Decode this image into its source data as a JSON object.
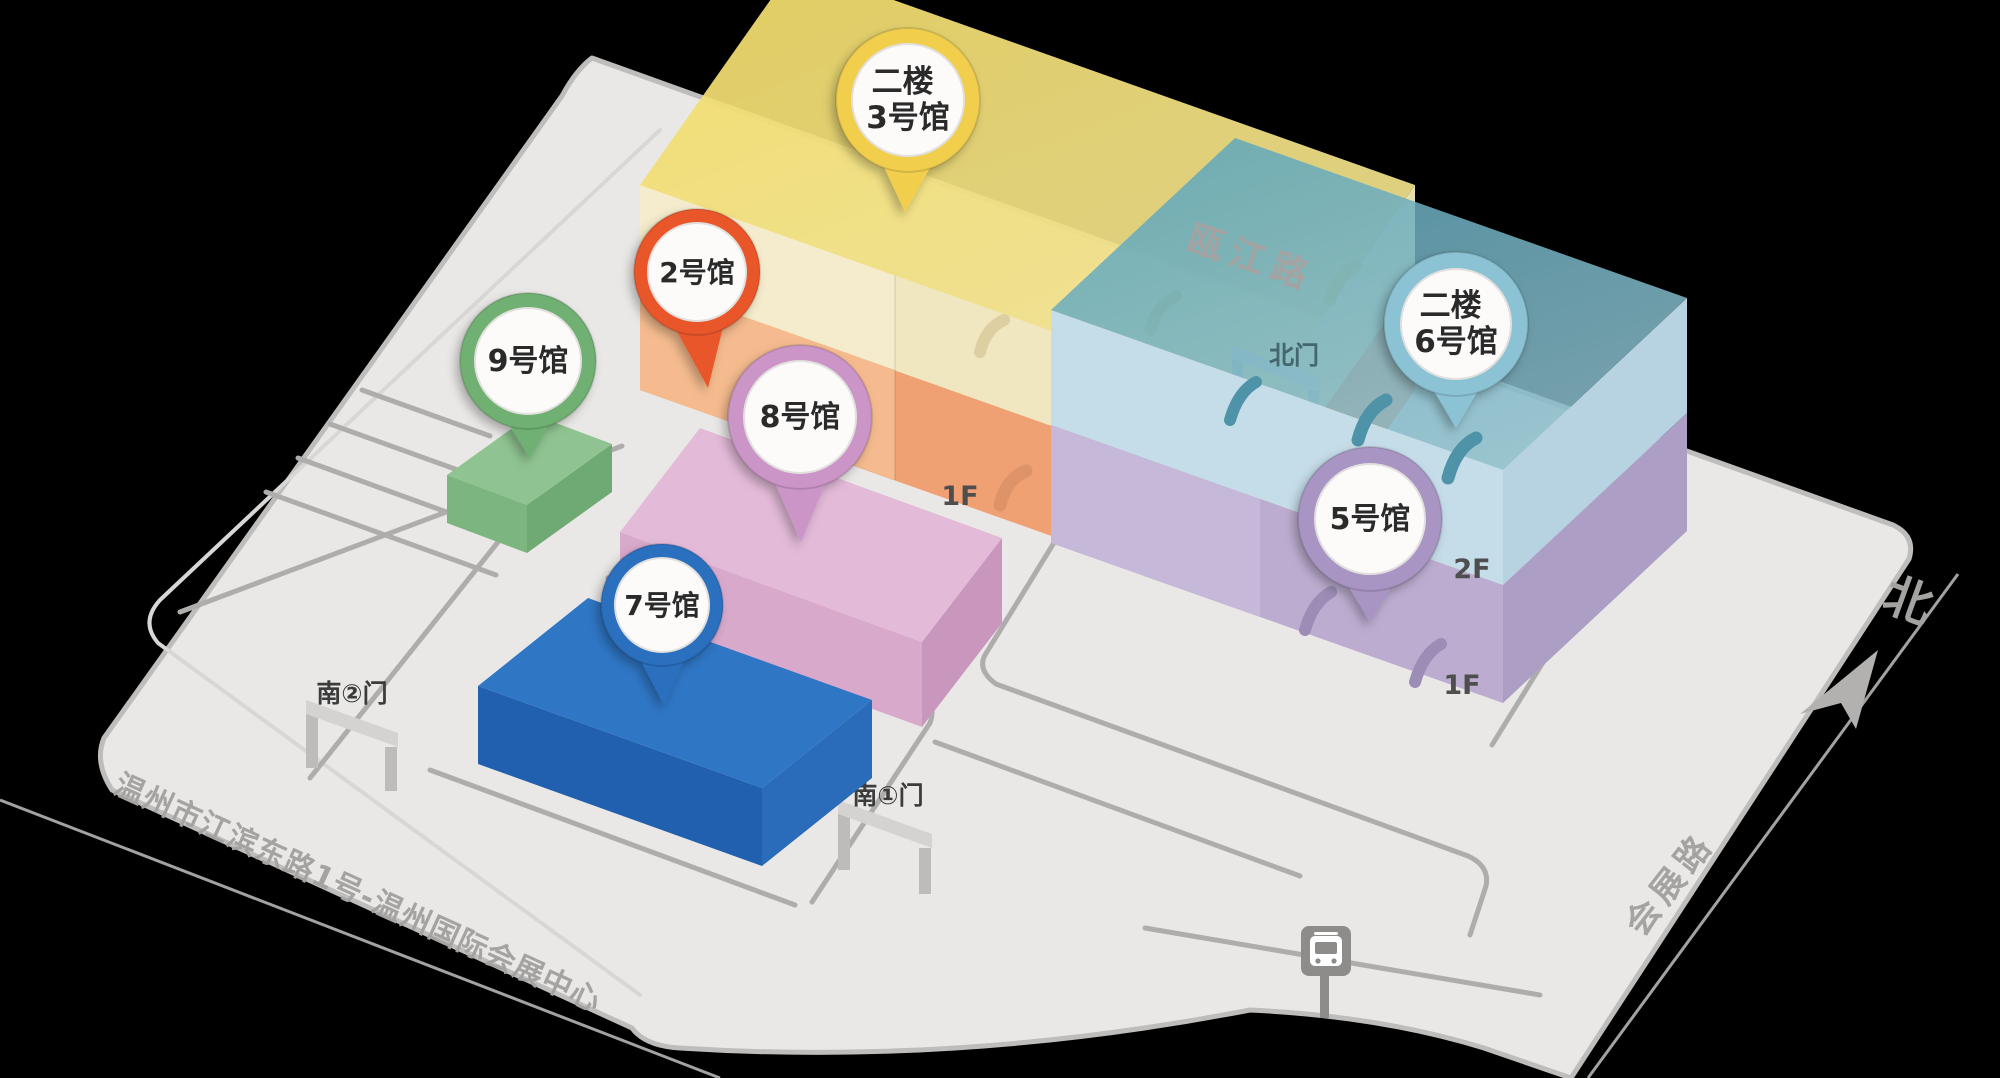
{
  "map": {
    "background": "#000000",
    "ground": "#E9E8E6"
  },
  "pins": [
    {
      "id": "hall-3",
      "lines": [
        "二楼",
        "3号馆"
      ],
      "color": "#F2CE4E"
    },
    {
      "id": "hall-2",
      "lines": [
        "2号馆"
      ],
      "color": "#E8562B"
    },
    {
      "id": "hall-9",
      "lines": [
        "9号馆"
      ],
      "color": "#6FB072"
    },
    {
      "id": "hall-8",
      "lines": [
        "8号馆"
      ],
      "color": "#CB95C7"
    },
    {
      "id": "hall-7",
      "lines": [
        "7号馆"
      ],
      "color": "#2B6FBE"
    },
    {
      "id": "hall-6",
      "lines": [
        "二楼",
        "6号馆"
      ],
      "color": "#8BC3D4"
    },
    {
      "id": "hall-5",
      "lines": [
        "5号馆"
      ],
      "color": "#A995C3"
    }
  ],
  "roads": {
    "top": "瓯江路",
    "right": "会展路",
    "address": "温州市江滨东路1号-温州国际会展中心"
  },
  "gates": {
    "north": "北门",
    "south1": "南①门",
    "south2": "南②门"
  },
  "compass": {
    "north": "北"
  },
  "floors": {
    "main_building_1f": "1F",
    "east_building_2f": "2F",
    "east_building_1f": "1F"
  }
}
